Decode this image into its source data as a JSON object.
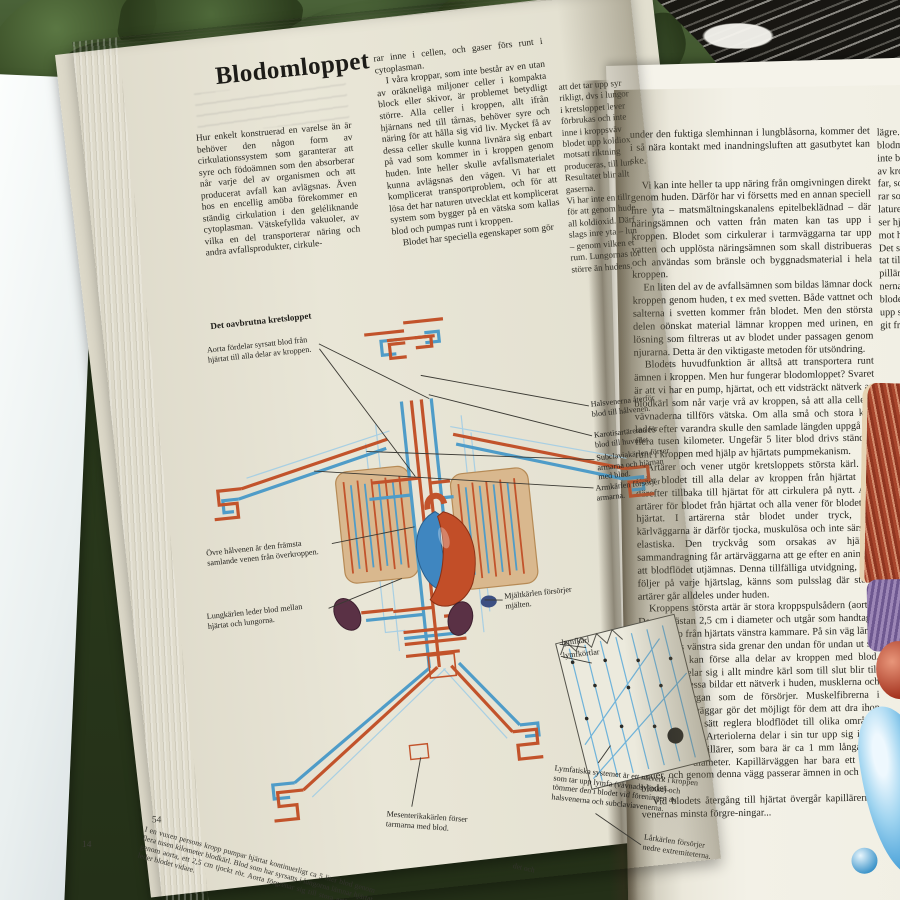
{
  "colors": {
    "artery": "#c2532b",
    "vein": "#5aa7d4",
    "lung": "#d9b88e",
    "kidney": "#5a3145",
    "page": "#f1efe3",
    "grass": "#2c3d22"
  },
  "leftPage": {
    "page_number": "54",
    "under_page_number": "14",
    "title": "Blodomloppet",
    "col1": "Hur enkelt konstruerad en varelse än är behöver den någon form av cirkulationssystem som garanterar att syre och födoämnen som den absorberar når varje del av organismen och att producerat avfall kan avlägsnas. Även hos en encellig amöba förekommer en ständig cirkulation i den geléliknande cytoplasman. Vätskefyllda vakuoler, av vilka en del transporterar näring och andra avfallsprodukter, cirkule-",
    "col2_p1": "rar inne i cellen, och gaser förs runt i cytoplasman.",
    "col2_p2": "I våra kroppar, som inte består av en utan av oräkneliga miljoner celler i kompakta block eller skivor, är problemet betydligt större. Alla celler i kroppen, allt ifrån hjärnans ned till tårnas, behöver syre och näring för att hålla sig vid liv. Mycket få av dessa celler skulle kunna livnära sig enbart på vad som kommer in i kroppen genom huden. Inte heller skulle avfallsmaterialet kunna avlägsnas den vägen. Vi har ett komplicerat transportproblem, och för att lösa det har naturen utvecklat ett komplicerat system som bygger på en vätska som kallas blod och pumpas runt i kroppen.",
    "col2_p3": "Blodet har speciella egenskaper som gör",
    "col3": "att det tar upp syr\nrikligt, dvs i lungor\ni kretsloppet lever\nförbrukas och inte\ninne i kroppsväv\nblodet upp koldiox\nmotsatt riktning\nproduceras, till lun\nResultatet blir allt\ngaserna.\nVi har inte en tillr\nför att genom hude\nall koldioxid. Därf\nslags inre yta – lun\n– genom vilken et\nrum. Lungornas tot\nstörre än hudens.",
    "diagram_heading": "Det oavbrutna kretsloppet",
    "labels": {
      "aorta": "Aorta fördelar syrsatt blod från hjärtat till alla delar av kroppen.",
      "hals": "Halsvenerna återför blod till hålvenen.",
      "karotis": "Karotisartärerna för blod till huvudet.",
      "subclavia": "Subclaviakärlen förser armarna och hjärnan med blod.",
      "armkarlen": "Armkärlen försörjer armarna.",
      "ovre": "Övre hålvenen är den främsta samlande venen från överkroppen.",
      "lungkarlen": "Lungkärlen leder blod mellan hjärtat och lungorna.",
      "mjalt": "Mjältkärlen försörjer mjälten.",
      "lymfkarl": "lymfkärl",
      "lymfkortlar": "lymfkörtlar",
      "lymfatiska": "Lymfatiska systemet är ett nätverk i kroppen som tar upp lymfa (vävnadsvätska) och tömmer den i blodet vid föreningen av halsvenerna och subclaviavenerna.",
      "mesenterika": "Mesenterikakärlen förser tarmarna med blod.",
      "larkarlen": "Lårkärlen försörjer nedre extremiteterna."
    },
    "caption": "I en vuxen persons kropp pumpar hjärtat kontinuerligt ca 5 liter blod genom flera tusen kilometer blodkärl. Blod som har syrsatts i lungorna lämnar hjärtat genom aorta, ett 2,5 cm tjockt rör. Aorta förgrenar sig till stora artärer som leder blodet vidare.",
    "caption_fragment": "det och"
  },
  "rightPage": {
    "paragraphs": [
      "under den fuktiga slemhinnan i lungblåsorna, kommer det i så nära kontakt med inandningsluften att gasutbytet kan ske.",
      "Vi kan inte heller ta upp näring från omgivningen direkt genom huden. Därför har vi försetts med en annan speciell inre yta – matsmältningskanalens epitelbeklädnad – där näringsämnen och vatten från maten kan tas upp i kroppen. Blodet som cirkulerar i tarmväggarna tar upp vatten och upplösta näringsämnen som skall distribueras och användas som bränsle och byggnadsmaterial i hela kroppen.",
      "En liten del av de avfallsämnen som bildas lämnar dock kroppen genom huden, t ex med svetten. Både vattnet och salterna i svetten kommer från blodet. Men den största delen oönskat material lämnar kroppen med urinen, en lösning som filtreras ut av blodet under passagen genom njurarna. Detta är den viktigaste metoden för utsöndring.",
      "Blodets huvudfunktion är alltså att transportera runt ämnen i kroppen. Men hur fungerar blodomloppet? Svaret är att vi har en pump, hjärtat, och ett vidsträckt nätverk av blodkärl som når varje vrå av kroppen, så att alla celler i vävnaderna tillförs vätska. Om alla små och stora kärl lades efter varandra skulle den samlade längden uppgå till flera tusen kilometer. Ungefär 5 liter blod drivs ständigt runt i kroppen med hjälp av hjärtats pumpmekanism.",
      "Artärer och vener utgör kretsloppets största kärl. De leder blodet till alla delar av kroppen från hjärtat och därefter tillbaka till hjärtat för att cirkulera på nytt. Alla artärer för blodet från hjärtat och alla vener för blodet till hjärtat. I artärerna står blodet under tryck, och kärlväggarna är därför tjocka, muskulösa och inte särskilt elastiska. Den tryckvåg som orsakas av hjärtats sammandragning får artärväggarna att ge efter en aning så att blodflödet utjämnas. Denna tillfälliga utvidgning, som följer på varje hjärtslag, känns som pulsslag där större artärer går alldeles under huden.",
      "Kroppens största artär är stora kroppspulsådern (aorta). Den är nästan 2,5 cm i diameter och utgår som handtaget på en käpp från hjärtats vänstra kammare. På sin väg längs ryggradens vänstra sida grenar den undan för undan ut sig så att den kan förse alla delar av kroppen med blod. Artärerna delar sig i allt mindre kärl som till slut blir till arterioler. Dessa bildar ett nätverk i huden, musklerna och de andra organ som de försörjer. Muskelfibrerna i arteriolernas väggar gör det möjligt för dem att dra ihop sig och på så sätt reglera blodflödet till olika områden alltefter behov. Arteriolerna delar i sin tur upp sig i små hårrörskärl, kapillärer, som bara är ca 1 mm långa och 0,01 mm i diameter. Kapillärväggen har bara ett lager celler, och genom denna vägg passerar ämnen in och ut ur blodet.",
      "Vid blodets återgång till hjärtat övergår kapillärerna i venernas minsta förgre-ningar..."
    ],
    "col2_fragment": "lägre. D\nblodmä\ninte blo\nav krop\nfar, som\nrar som\nlaturen\nser hjälp\nmot hjä\nDet st\ntat till\npillärer\nnerna t\nblodet r\nupp syr\ngit från"
  }
}
